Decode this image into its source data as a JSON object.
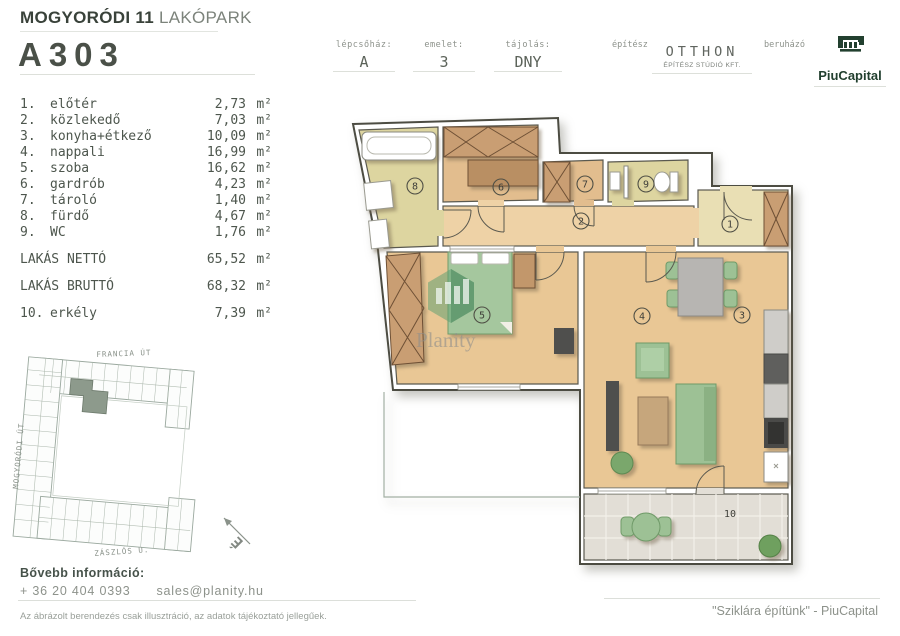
{
  "header": {
    "project_title_bold": "MOGYORÓDI 11",
    "project_title_light": " LAKÓPARK",
    "unit_id": "A303",
    "cells": [
      {
        "label": "lépcsőház:",
        "value": "A"
      },
      {
        "label": "emelet:",
        "value": "3"
      },
      {
        "label": "tájolás:",
        "value": "DNY"
      }
    ],
    "architect_label": "építész",
    "architect_name": "OTTHON",
    "architect_sub": "ÉPÍTÉSZ STÚDIÓ KFT.",
    "developer_label": "beruházó",
    "developer_name": "PiuCapital"
  },
  "rooms": [
    {
      "num": "1.",
      "name": "előtér",
      "area": "2,73",
      "unit": "m²"
    },
    {
      "num": "2.",
      "name": "közlekedő",
      "area": "7,03",
      "unit": "m²"
    },
    {
      "num": "3.",
      "name": "konyha+étkező",
      "area": "10,09",
      "unit": "m²"
    },
    {
      "num": "4.",
      "name": "nappali",
      "area": "16,99",
      "unit": "m²"
    },
    {
      "num": "5.",
      "name": "szoba",
      "area": "16,62",
      "unit": "m²"
    },
    {
      "num": "6.",
      "name": "gardrób",
      "area": "4,23",
      "unit": "m²"
    },
    {
      "num": "7.",
      "name": "tároló",
      "area": "1,40",
      "unit": "m²"
    },
    {
      "num": "8.",
      "name": "fürdő",
      "area": "4,67",
      "unit": "m²"
    },
    {
      "num": "9.",
      "name": "WC",
      "area": "1,76",
      "unit": "m²"
    }
  ],
  "totals": [
    {
      "label": "LAKÁS NETTÓ",
      "area": "65,52",
      "unit": "m²"
    },
    {
      "label": "LAKÁS BRUTTÓ",
      "area": "68,32",
      "unit": "m²"
    }
  ],
  "extra_room": {
    "num": "10.",
    "name": "erkély",
    "area": "7,39",
    "unit": "m²"
  },
  "site_plan": {
    "streets": [
      "FRANCIA ÚT",
      "MOGYORÓDI ÚT",
      "ZÁSZLÓS U."
    ],
    "compass": "É"
  },
  "plan": {
    "labels": [
      "1",
      "2",
      "3",
      "4",
      "5",
      "6",
      "7",
      "8",
      "9",
      "10"
    ],
    "watermark": "Planity"
  },
  "colors": {
    "brand_green": "#22402f",
    "text_dark": "#4a5048",
    "text_gray": "#8d928b",
    "floor_wood": "#e9c795",
    "floor_tile": "#ddd5a0"
  },
  "footer": {
    "info_label": "Bővebb információ:",
    "phone": "+ 36 20 404 0393",
    "email": "sales@planity.hu",
    "quote": "\"Sziklára építünk\" - PiuCapital",
    "disclaimer": "Az ábrázolt berendezés csak illusztráció, az adatok tájékoztató jellegűek."
  }
}
